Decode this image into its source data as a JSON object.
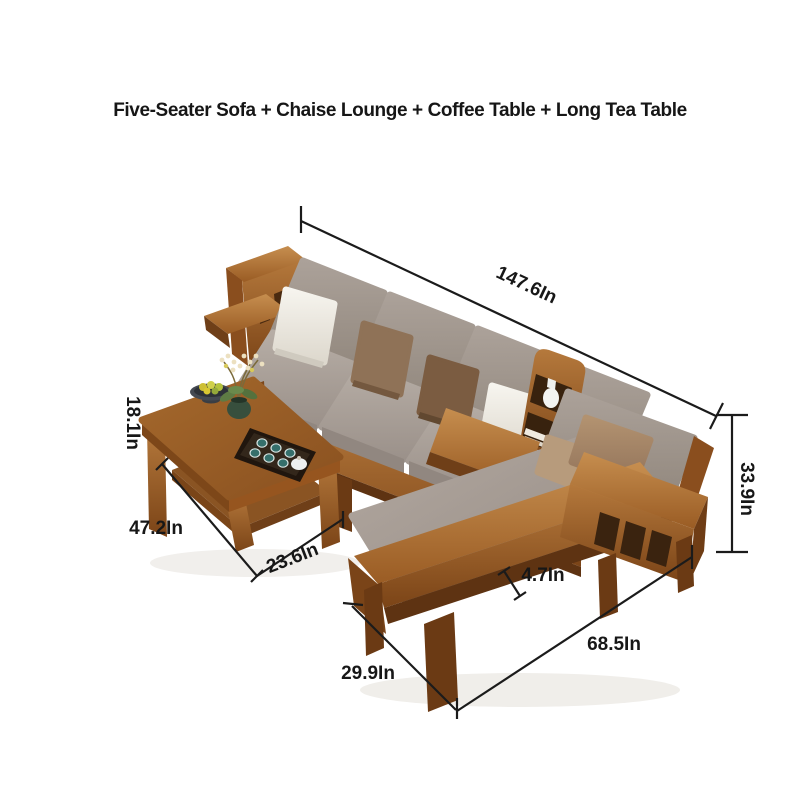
{
  "title": "Five-Seater Sofa + Chaise Lounge + Coffee Table + Long Tea Table",
  "annotations": {
    "sofa_length": "147.6In",
    "sofa_height": "33.9In",
    "table_height": "18.1In",
    "table_length": "47.2In",
    "table_width": "23.6In",
    "rail_width": "4.7In",
    "chaise_length": "68.5In",
    "chaise_width": "29.9In"
  },
  "colors": {
    "background": "#ffffff",
    "annotation": "#1b1b1b",
    "label_text": "#171717",
    "wood": "#96551f",
    "wood_dark": "#5e3312",
    "wood_light": "#c68e4f",
    "cushion_gray": "#a49a92",
    "cushion_shadow": "#8e847c",
    "pillow_white": "#f2f0ea",
    "pillow_brown": "#8f7257",
    "pillow_dark_brown": "#7b5c41",
    "pillow_tan": "#a98d6e",
    "plant_green": "#5e7b44",
    "cup_teal": "#356f6b",
    "tray": "#20160e"
  }
}
